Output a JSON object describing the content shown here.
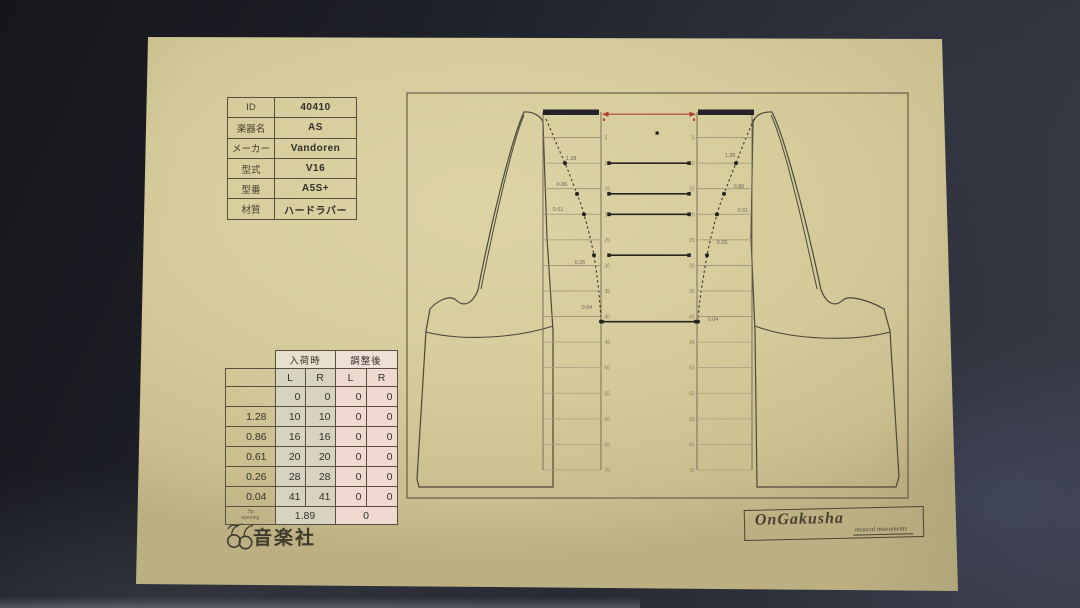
{
  "colors": {
    "paper": "#d5cb9a",
    "background_dark": "#1b1d23",
    "ink": "#3c372b",
    "accent_red": "#b23b30",
    "arrival_fill": "#d6d3c0",
    "adjusted_fill": "#f0d9d1"
  },
  "id_table": {
    "rows": [
      {
        "label": "ID",
        "value": "40410"
      },
      {
        "label": "楽器名",
        "value": "AS"
      },
      {
        "label": "メーカー",
        "value": "Vandoren"
      },
      {
        "label": "型式",
        "value": "V16"
      },
      {
        "label": "型番",
        "value": "A5S+"
      },
      {
        "label": "材質",
        "value": "ハードラバー"
      }
    ]
  },
  "measurement_table": {
    "group_headers": [
      "入荷時",
      "調整後"
    ],
    "sub_headers": [
      "L",
      "R",
      "L",
      "R"
    ],
    "rows": [
      {
        "label": "",
        "arrival": [
          "0",
          "0"
        ],
        "adjusted": [
          "0",
          "0"
        ]
      },
      {
        "label": "1.28",
        "arrival": [
          "10",
          "10"
        ],
        "adjusted": [
          "0",
          "0"
        ]
      },
      {
        "label": "0.86",
        "arrival": [
          "16",
          "16"
        ],
        "adjusted": [
          "0",
          "0"
        ]
      },
      {
        "label": "0.61",
        "arrival": [
          "20",
          "20"
        ],
        "adjusted": [
          "0",
          "0"
        ]
      },
      {
        "label": "0.26",
        "arrival": [
          "28",
          "28"
        ],
        "adjusted": [
          "0",
          "0"
        ]
      },
      {
        "label": "0.04",
        "arrival": [
          "41",
          "41"
        ],
        "adjusted": [
          "0",
          "0"
        ]
      }
    ],
    "footer": {
      "label": "Tip opening",
      "arrival": "1.89",
      "adjusted": "0"
    }
  },
  "diagram": {
    "ruler_ticks": [
      5,
      10,
      15,
      20,
      25,
      30,
      35,
      40,
      45,
      50,
      55,
      60,
      65,
      70
    ],
    "gauge_points": [
      {
        "gauge": "1.28",
        "tick": 10
      },
      {
        "gauge": "0.86",
        "tick": 16
      },
      {
        "gauge": "0.61",
        "tick": 20
      },
      {
        "gauge": "0.26",
        "tick": 28
      },
      {
        "gauge": "0.04",
        "tick": 41
      }
    ]
  },
  "footer": {
    "left_logo_text": "音楽社",
    "right_logo_line1": "OnGakusha",
    "right_logo_line2": "musical instruments"
  }
}
